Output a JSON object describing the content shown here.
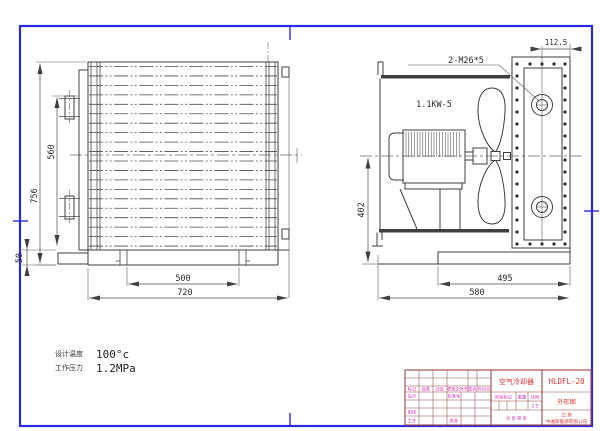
{
  "front_view": {
    "dim_total_height": "756",
    "dim_fin_height": "560",
    "dim_base_height": "50",
    "dim_foot_spacing": "500",
    "dim_total_width": "720"
  },
  "side_view": {
    "dim_port_offset": "112.5",
    "dim_axis_height": "402",
    "dim_base_width": "495",
    "dim_total_width": "580",
    "port_label": "2-M26*5",
    "motor_label": "1.1KW-5"
  },
  "specs": {
    "design_temp_label": "设计温度",
    "design_temp_value": "100°c",
    "working_pressure_label": "工作压力",
    "working_pressure_value": "1.2MPa"
  },
  "title_block": {
    "product_name": "空气冷却器",
    "model": "HLDFL-20",
    "drawing_type": "外形图",
    "region": "江 苏",
    "company": "中通新能源有限公司",
    "fields": {
      "mark": "标记",
      "count": "处数",
      "zone": "分区",
      "change_file_no": "更改文件号",
      "signature": "签名",
      "date": "年月日",
      "design": "设计",
      "standardization": "标准化",
      "review": "审核",
      "process": "工艺",
      "approve": "批准",
      "stage_mark": "阶段标记",
      "weight": "重量",
      "scale": "比例",
      "scale_value": "1:5",
      "sheets": "共 张 第 张"
    }
  },
  "colors": {
    "frame_blue": "#2a2ae0",
    "line_dark": "#3f3f3f",
    "title_line_red": "#9a4545",
    "title_text_magenta": "#d626b0",
    "title_text_red": "#e23030"
  }
}
